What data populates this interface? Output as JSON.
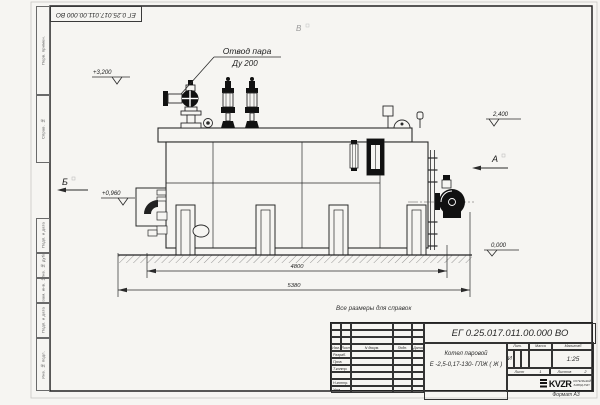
{
  "frame": {
    "side_labels": [
      "Перв. примен.",
      "Справ. №",
      "Подп. и дата",
      "Инв. № дубл.",
      "Взам. инв. №",
      "Подп. и дата",
      "Инв. № подл."
    ],
    "format_note": "Формат А3"
  },
  "notes": {
    "reference": "Все размеры для справок"
  },
  "drawing": {
    "callout": {
      "line1": "Отвод пара",
      "line2": "Ду 200"
    },
    "elevations": [
      "+3,200",
      "+0,960",
      "2,400",
      "0,000"
    ],
    "views": {
      "a": "А",
      "b": "Б",
      "v": "В"
    },
    "dimensions": [
      "4800",
      "5380"
    ]
  },
  "title_block": {
    "doc_number": "ЕГ 0.25.017.011.00.000  ВО",
    "product_line1": "Котел паровой",
    "product_line2": "Е -2,5-0,17-130- ГЛЖ ( Ж )",
    "col_izm": "Изм.",
    "col_list": "Лист",
    "col_doc": "N докум.",
    "col_sign": "Подп.",
    "col_date": "Дата",
    "row_razrab": "Разраб.",
    "row_prov": "Пров.",
    "row_tkontr": "Т.контр.",
    "row_nkontr": "Н.контр.",
    "row_utv": "Утв.",
    "hdr_lit": "Лит.",
    "hdr_mass": "Масса",
    "hdr_scale": "Масштаб",
    "lit_value": "И",
    "scale_value": "1:25",
    "sheet_label": "Лист",
    "sheet_value": "1",
    "sheets_label": "Листов",
    "sheets_value": "2",
    "logo_text": "KVZR",
    "logo_sub1": "КОТЕЛЬНЫЙ",
    "logo_sub2": "ЗАВОД РЭП"
  }
}
